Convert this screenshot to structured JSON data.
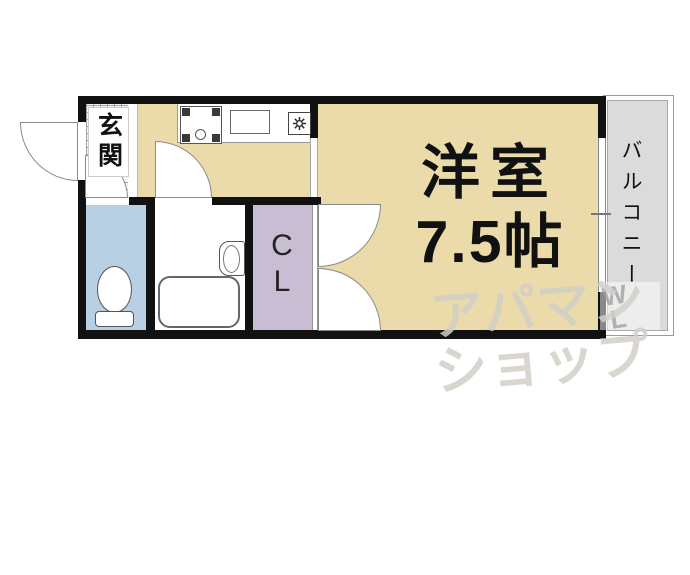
{
  "plan": {
    "entrance": {
      "label": "玄関"
    },
    "closet": {
      "line1": "C",
      "line2": "L"
    },
    "main_room": {
      "line1": "洋室",
      "line2": "7.5帖"
    },
    "balcony": {
      "label": "バルコニー"
    },
    "watermark": {
      "line1": "アパマン",
      "line2": "ショップ",
      "mark1": "W",
      "mark2": "L"
    },
    "colors": {
      "floor_tan": "#ecdbaa",
      "toilet_blue": "#b9cfe3",
      "closet_purple": "#c8bdd2",
      "balcony_grey": "#dbdbdc",
      "wall_black": "#111111"
    }
  }
}
